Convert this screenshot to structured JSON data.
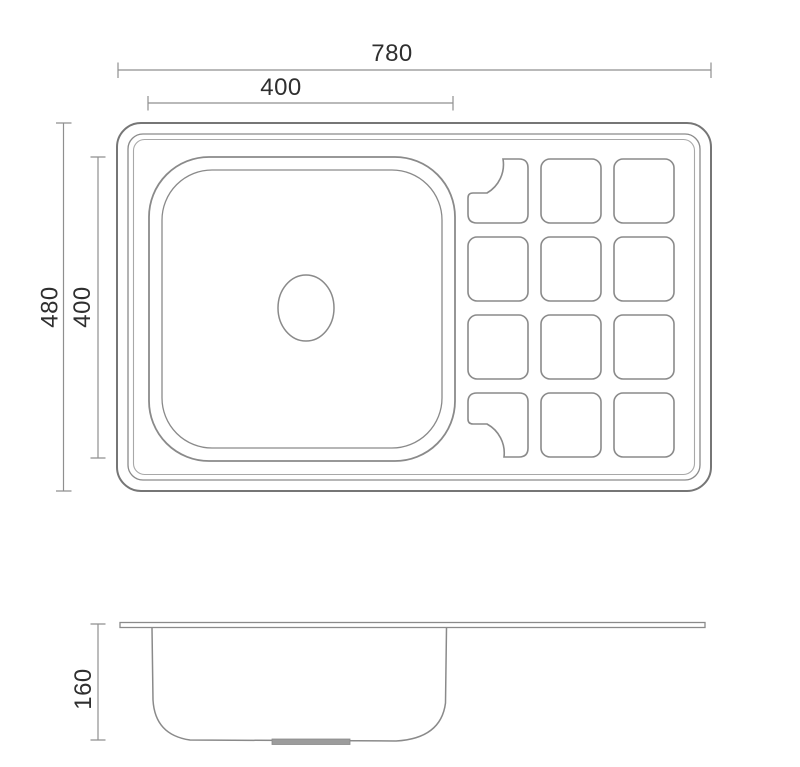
{
  "dimensions": {
    "overall_width": "780",
    "bowl_width": "400",
    "overall_depth": "480",
    "bowl_depth": "400",
    "bowl_height": "160"
  },
  "colors": {
    "background": "#ffffff",
    "outline-strong": "#767676",
    "outline": "#8a8a8a",
    "outline-light": "#a8a8a8",
    "dim-line": "#8f8f8f",
    "text": "#2f2f2f",
    "drain-fill": "#9c9c9c"
  }
}
